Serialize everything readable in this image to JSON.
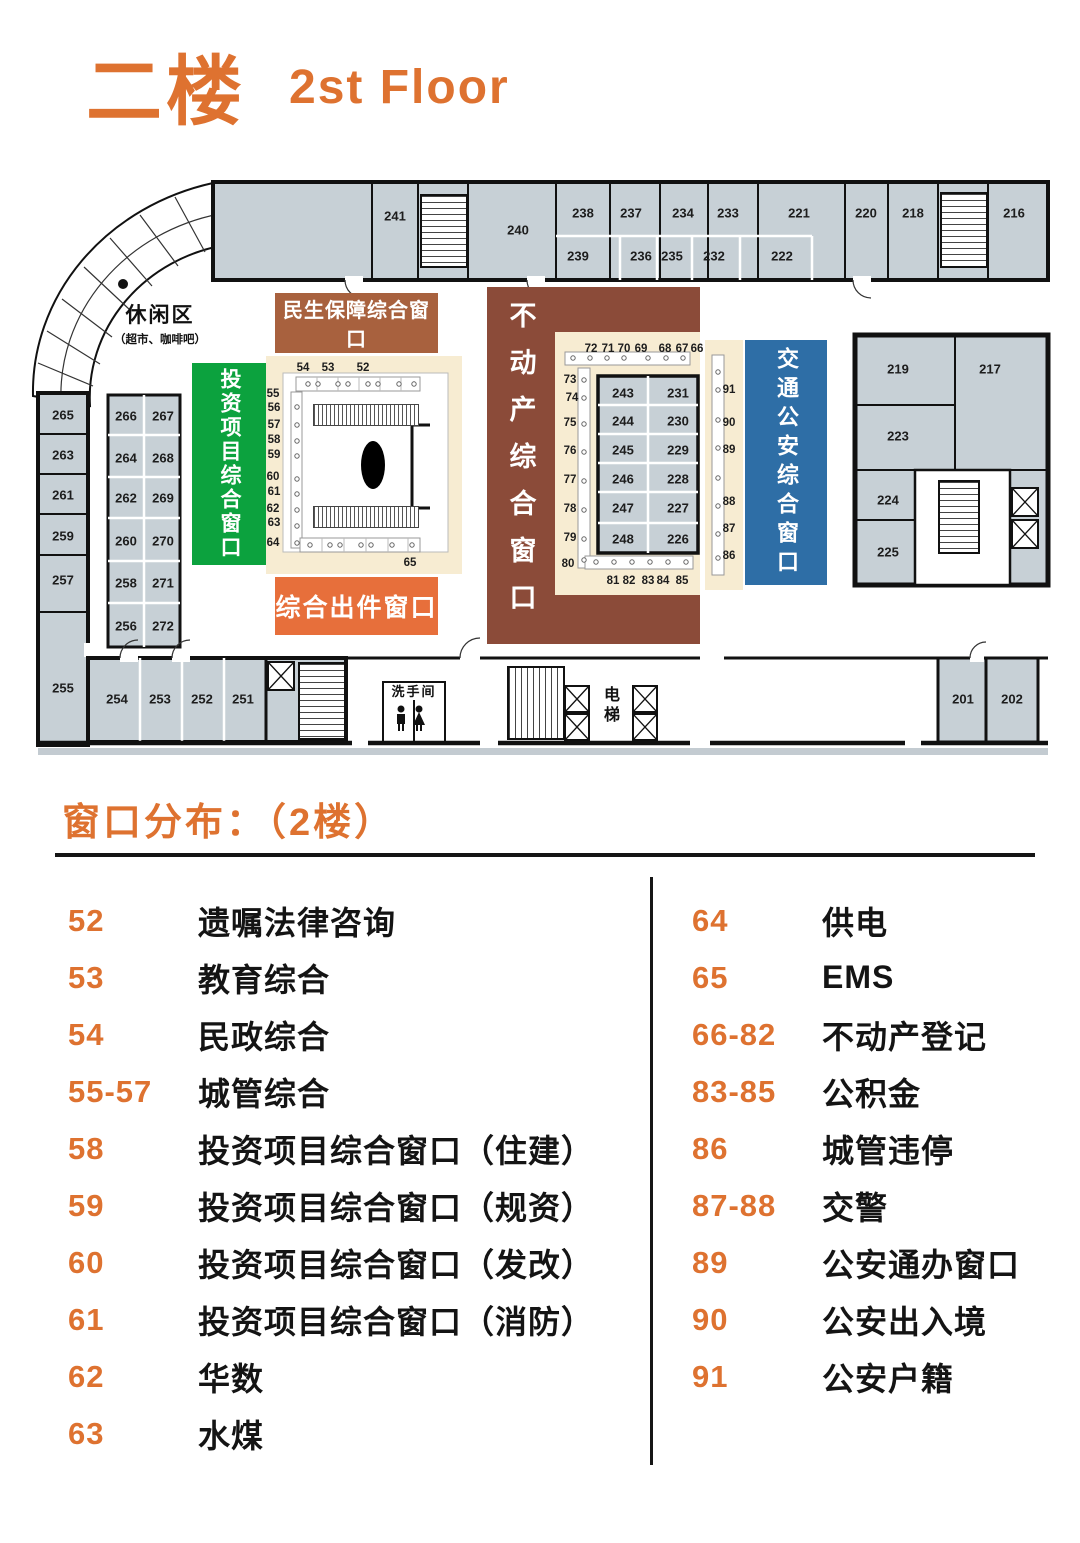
{
  "header": {
    "title_cn": "二楼",
    "title_en": "2st Floor"
  },
  "plan": {
    "leisure_label": "休闲区",
    "leisure_sub": "（超市、咖啡吧）",
    "banners": {
      "minsheng": "民生保障综合窗口",
      "touzi": "投资项目综合窗口",
      "chujian": "综合出件窗口",
      "budongchan": "不动产综合窗口",
      "jiaotong": "交通公安综合窗口"
    },
    "restroom": "洗手间",
    "elevator": "电梯",
    "rooms": {
      "201": "201",
      "202": "202",
      "216": "216",
      "217": "217",
      "218": "218",
      "219": "219",
      "220": "220",
      "221": "221",
      "222": "222",
      "223": "223",
      "224": "224",
      "225": "225",
      "226": "226",
      "227": "227",
      "228": "228",
      "229": "229",
      "230": "230",
      "231": "231",
      "232": "232",
      "233": "233",
      "234": "234",
      "235": "235",
      "236": "236",
      "237": "237",
      "238": "238",
      "239": "239",
      "240": "240",
      "241": "241",
      "243": "243",
      "244": "244",
      "245": "245",
      "246": "246",
      "247": "247",
      "248": "248",
      "251": "251",
      "252": "252",
      "253": "253",
      "254": "254",
      "255": "255",
      "256": "256",
      "257": "257",
      "258": "258",
      "259": "259",
      "260": "260",
      "261": "261",
      "262": "262",
      "263": "263",
      "264": "264",
      "265": "265",
      "266": "266",
      "267": "267",
      "268": "268",
      "269": "269",
      "270": "270",
      "271": "271",
      "272": "272"
    },
    "windows": {
      "52": "52",
      "53": "53",
      "54": "54",
      "55": "55",
      "56": "56",
      "57": "57",
      "58": "58",
      "59": "59",
      "60": "60",
      "61": "61",
      "62": "62",
      "63": "63",
      "64": "64",
      "65": "65",
      "66": "66",
      "67": "67",
      "68": "68",
      "69": "69",
      "70": "70",
      "71": "71",
      "72": "72",
      "73": "73",
      "74": "74",
      "75": "75",
      "76": "76",
      "77": "77",
      "78": "78",
      "79": "79",
      "80": "80",
      "81": "81",
      "82": "82",
      "83": "83",
      "84": "84",
      "85": "85",
      "86": "86",
      "87": "87",
      "88": "88",
      "89": "89",
      "90": "90",
      "91": "91"
    }
  },
  "legend": {
    "title": "窗口分布：（2楼）",
    "left": [
      {
        "num": "52",
        "label": "遗嘱法律咨询"
      },
      {
        "num": "53",
        "label": "教育综合"
      },
      {
        "num": "54",
        "label": "民政综合"
      },
      {
        "num": "55-57",
        "label": "城管综合"
      },
      {
        "num": "58",
        "label": "投资项目综合窗口（住建）"
      },
      {
        "num": "59",
        "label": "投资项目综合窗口（规资）"
      },
      {
        "num": "60",
        "label": "投资项目综合窗口（发改）"
      },
      {
        "num": "61",
        "label": "投资项目综合窗口（消防）"
      },
      {
        "num": "62",
        "label": "华数"
      },
      {
        "num": "63",
        "label": "水煤"
      }
    ],
    "right": [
      {
        "num": "64",
        "label": "供电"
      },
      {
        "num": "65",
        "label": "EMS"
      },
      {
        "num": "66-82",
        "label": "不动产登记"
      },
      {
        "num": "83-85",
        "label": "公积金"
      },
      {
        "num": "86",
        "label": "城管违停"
      },
      {
        "num": "87-88",
        "label": "交警"
      },
      {
        "num": "89",
        "label": "公安通办窗口"
      },
      {
        "num": "90",
        "label": "公安出入境"
      },
      {
        "num": "91",
        "label": "公安户籍"
      }
    ]
  },
  "colors": {
    "accent_orange": "#DE7230",
    "banner_brown": "#A8613E",
    "banner_green": "#0CA23E",
    "banner_orange": "#E76F3B",
    "banner_maroon": "#8B4B39",
    "banner_blue": "#2E6EA6",
    "zone_cream": "#F7ECD2",
    "room_gray": "#C7D0D6"
  }
}
